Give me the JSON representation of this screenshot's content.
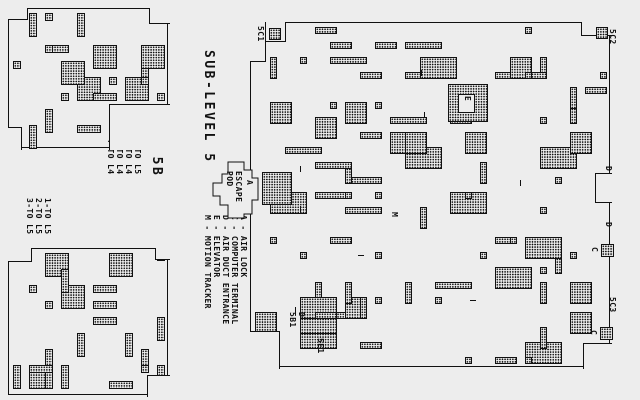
{
  "colors": {
    "bg": "#ededed",
    "ink": "#111111"
  },
  "titles": {
    "main": "SUB-LEVEL 5",
    "duct_top": "DUCT 5B"
  },
  "escape_pod": {
    "lines": [
      "ESCAPE",
      "POD"
    ]
  },
  "legend": {
    "items": [
      "A - AIR LOCK",
      "C - COMPUTER TERMINAL",
      "D - AIR DUCT ENTRANCE",
      "E - ELEVATOR",
      "M - MOTION TRACKER"
    ]
  },
  "duct_top_legend": {
    "items": [
      "1-TO L5",
      "2-TO L4",
      "3-TO L4",
      "4-TO L4"
    ]
  },
  "duct_bottom_legend": {
    "items": [
      "1-TO L5",
      "2-TO L5",
      "3-TO L5"
    ]
  },
  "markers": [
    {
      "kind": "rot",
      "name": "marker-5C1",
      "label": "5C1",
      "x": 265,
      "y": 26
    },
    {
      "kind": "box",
      "name": "duct-box-5C1",
      "x": 269,
      "y": 28,
      "w": 12,
      "h": 12
    },
    {
      "kind": "box",
      "name": "duct-box-5C2",
      "x": 596,
      "y": 27,
      "w": 12,
      "h": 12
    },
    {
      "kind": "rot",
      "name": "marker-5C2",
      "label": "5C2",
      "x": 617,
      "y": 29
    },
    {
      "kind": "rot",
      "name": "marker-5C3",
      "label": "5C3",
      "x": 617,
      "y": 297
    },
    {
      "kind": "rot",
      "name": "marker-5E1",
      "label": "5E1",
      "x": 325,
      "y": 338
    },
    {
      "kind": "rot",
      "name": "marker-duct-5B1",
      "label": "D\n5B1",
      "x": 306,
      "y": 312
    },
    {
      "kind": "rot",
      "name": "marker-airlock-A",
      "label": "A",
      "x": 254,
      "y": 180
    },
    {
      "kind": "dbox",
      "name": "airlock-room",
      "x": 262,
      "y": 172,
      "w": 30,
      "h": 33
    },
    {
      "kind": "dbox",
      "name": "elevator-room",
      "x": 448,
      "y": 84,
      "w": 40,
      "h": 38
    },
    {
      "kind": "pbox",
      "name": "elevator-shaft",
      "x": 458,
      "y": 94,
      "w": 17,
      "h": 19
    },
    {
      "kind": "rot",
      "name": "marker-elevator-E",
      "label": "E",
      "x": 472,
      "y": 96
    },
    {
      "kind": "rot",
      "name": "marker-duct-D-1",
      "label": "D",
      "x": 613,
      "y": 166
    },
    {
      "kind": "rot",
      "name": "marker-duct-D-2",
      "label": "D",
      "x": 613,
      "y": 222
    },
    {
      "kind": "rot",
      "name": "marker-computer-C1",
      "label": "C",
      "x": 599,
      "y": 247
    },
    {
      "kind": "box",
      "name": "terminal-box-1",
      "x": 601,
      "y": 244,
      "w": 13,
      "h": 13
    },
    {
      "kind": "rot",
      "name": "marker-computer-C2",
      "label": "C",
      "x": 598,
      "y": 330
    },
    {
      "kind": "box",
      "name": "terminal-box-2",
      "x": 600,
      "y": 327,
      "w": 13,
      "h": 13
    },
    {
      "kind": "rot",
      "name": "marker-motion-M",
      "label": "M",
      "x": 399,
      "y": 212
    },
    {
      "kind": "tick",
      "name": "door-tick",
      "x": 300,
      "y": 166,
      "w": 1,
      "h": 6
    },
    {
      "kind": "tick",
      "name": "door-tick",
      "x": 300,
      "y": 206,
      "w": 1,
      "h": 6
    },
    {
      "kind": "tick",
      "name": "door-tick",
      "x": 421,
      "y": 70,
      "w": 1,
      "h": 6
    },
    {
      "kind": "tick",
      "name": "door-tick",
      "x": 424,
      "y": 112,
      "w": 1,
      "h": 6
    },
    {
      "kind": "tick",
      "name": "door-tick",
      "x": 358,
      "y": 255,
      "w": 6,
      "h": 1
    },
    {
      "kind": "tick",
      "name": "door-tick",
      "x": 470,
      "y": 300,
      "w": 6,
      "h": 1
    },
    {
      "kind": "tick",
      "name": "door-tick",
      "x": 520,
      "y": 180,
      "w": 1,
      "h": 6
    },
    {
      "kind": "tick",
      "name": "door-tick",
      "x": 295,
      "y": 307,
      "w": 1,
      "h": 6
    }
  ],
  "mazes": [
    {
      "name": "main-maze-sublevel-5",
      "x": 250,
      "y": 22,
      "w": 360,
      "h": 345,
      "cell": 15,
      "cols": 24,
      "rows": 23,
      "seed": 1987,
      "rects": 88,
      "maxw": 3,
      "maxh": 2,
      "notches": [
        {
          "x": -1,
          "y": -1,
          "w": 36,
          "h": 20,
          "sides": "rb"
        },
        {
          "x": -1,
          "y": -1,
          "w": 16,
          "h": 40,
          "sides": "rb"
        },
        {
          "x": 330,
          "y": -1,
          "w": 31,
          "h": 14,
          "sides": "lb"
        },
        {
          "x": -1,
          "y": 308,
          "w": 30,
          "h": 38,
          "sides": "tr"
        },
        {
          "x": 332,
          "y": 320,
          "w": 29,
          "h": 26,
          "sides": "lt"
        },
        {
          "x": 344,
          "y": 150,
          "w": 17,
          "h": 30,
          "sides": "ltb"
        }
      ]
    },
    {
      "name": "duct-5b-maze",
      "x": 8,
      "y": 8,
      "w": 160,
      "h": 140,
      "cell": 16,
      "cols": 10,
      "rows": 9,
      "seed": 77,
      "rects": 26,
      "maxw": 2,
      "maxh": 2,
      "notches": [
        {
          "x": -1,
          "y": -1,
          "w": 20,
          "h": 12,
          "sides": "rb"
        },
        {
          "x": 140,
          "y": -1,
          "w": 21,
          "h": 16,
          "sides": "lb"
        },
        {
          "x": 100,
          "y": 95,
          "w": 61,
          "h": 46,
          "sides": "lt"
        },
        {
          "x": -1,
          "y": 118,
          "w": 14,
          "h": 23,
          "sides": "tr"
        }
      ]
    },
    {
      "name": "duct-5c-maze",
      "x": 8,
      "y": 248,
      "w": 160,
      "h": 147,
      "cell": 16,
      "cols": 10,
      "rows": 9,
      "seed": 412,
      "rects": 26,
      "maxw": 2,
      "maxh": 2,
      "notches": [
        {
          "x": -1,
          "y": -1,
          "w": 24,
          "h": 14,
          "sides": "rb"
        },
        {
          "x": 146,
          "y": -1,
          "w": 15,
          "h": 12,
          "sides": "lb"
        },
        {
          "x": 138,
          "y": 126,
          "w": 23,
          "h": 22,
          "sides": "lt"
        }
      ]
    }
  ]
}
